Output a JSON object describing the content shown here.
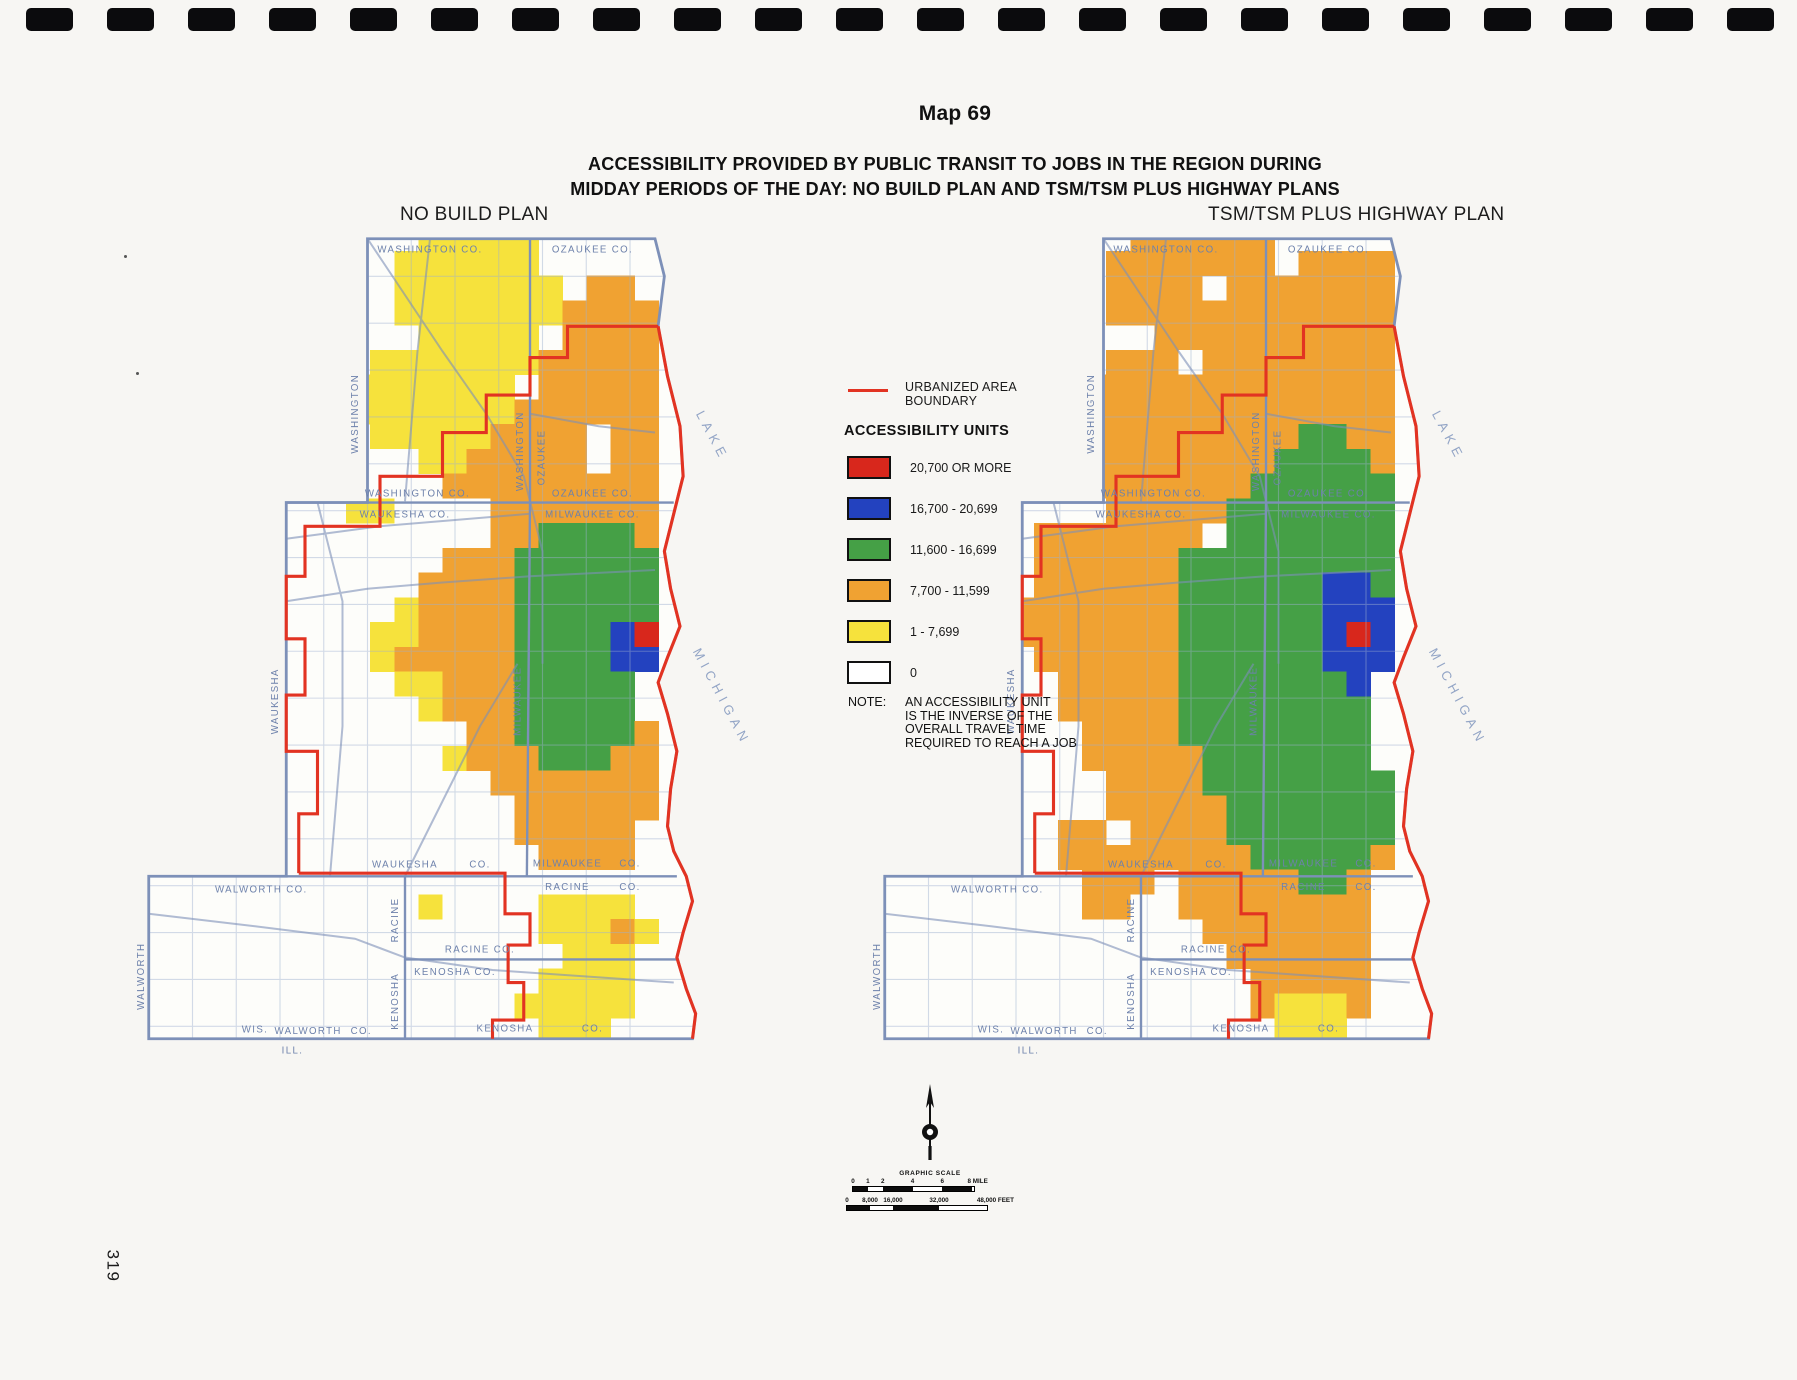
{
  "page": {
    "number": "319",
    "background": "#f7f6f3",
    "perforation_count": 23
  },
  "title": {
    "map_no": "Map 69",
    "line1": "ACCESSIBILITY PROVIDED BY PUBLIC TRANSIT TO JOBS IN THE REGION DURING",
    "line2": "MIDDAY PERIODS OF THE DAY:  NO BUILD PLAN AND TSM/TSM PLUS HIGHWAY PLANS"
  },
  "legend": {
    "boundary_label_line1": "URBANIZED AREA",
    "boundary_label_line2": "BOUNDARY",
    "boundary_color": "#e23322",
    "units_title": "ACCESSIBILITY UNITS",
    "items": [
      {
        "label": "20,700 OR MORE",
        "color": "#d8271c"
      },
      {
        "label": "16,700 - 20,699",
        "color": "#2342bf"
      },
      {
        "label": "11,600 - 16,699",
        "color": "#45a046"
      },
      {
        "label": "7,700 - 11,599",
        "color": "#f0a232"
      },
      {
        "label": "1 - 7,699",
        "color": "#f6e23c"
      },
      {
        "label": "0",
        "color": "#ffffff"
      }
    ],
    "note_label": "NOTE:",
    "note_lines": [
      "AN ACCESSIBILITY UNIT",
      "IS THE INVERSE OF THE",
      "OVERALL TRAVEL TIME",
      "REQUIRED TO REACH A JOB"
    ]
  },
  "scale": {
    "title": "GRAPHIC SCALE",
    "mile_ticks": [
      {
        "f": 0,
        "t": "0"
      },
      {
        "f": 0.125,
        "t": "1"
      },
      {
        "f": 0.25,
        "t": "2"
      },
      {
        "f": 0.5,
        "t": "4"
      },
      {
        "f": 0.75,
        "t": "6"
      },
      {
        "f": 1,
        "t": "8 MILE"
      }
    ],
    "feet_ticks": [
      {
        "f": 0,
        "t": "0"
      },
      {
        "f": 0.167,
        "t": "8,000"
      },
      {
        "f": 0.333,
        "t": "16,000"
      },
      {
        "f": 0.667,
        "t": "32,000"
      },
      {
        "f": 1,
        "t": "48,000 FEET"
      }
    ]
  },
  "palette": {
    "Y": "#f6e23c",
    "O": "#f0a232",
    "G": "#45a046",
    "B": "#2342bf",
    "R": "#d8271c"
  },
  "map_style": {
    "region_fill": "#fdfdfa",
    "line_color": "#7d90b8",
    "grid_color": "#9db0d0",
    "label_color": "#6d81ab",
    "lake_label_color": "#93a5c6",
    "urban_boundary_color": "#e23322"
  },
  "base_map": {
    "region": [
      [
        38,
        2
      ],
      [
        84,
        2
      ],
      [
        85.5,
        8
      ],
      [
        84.5,
        16
      ],
      [
        86,
        24
      ],
      [
        88,
        32
      ],
      [
        88.5,
        40
      ],
      [
        87,
        46
      ],
      [
        85.5,
        52
      ],
      [
        86.5,
        58
      ],
      [
        88,
        64
      ],
      [
        86,
        69
      ],
      [
        84.5,
        73
      ],
      [
        86,
        78
      ],
      [
        87.5,
        84
      ],
      [
        86.5,
        90
      ],
      [
        86,
        96
      ],
      [
        87,
        100
      ],
      [
        89,
        104
      ],
      [
        90,
        108
      ],
      [
        88.5,
        113
      ],
      [
        87.5,
        117
      ],
      [
        89,
        122
      ],
      [
        90.5,
        126
      ],
      [
        90,
        130
      ],
      [
        3,
        130
      ],
      [
        3,
        104
      ],
      [
        25,
        104
      ],
      [
        25,
        44.2
      ],
      [
        38,
        44.2
      ]
    ],
    "county_lines": [
      [
        [
          25,
          44.2
        ],
        [
          87,
          44.2
        ]
      ],
      [
        [
          3,
          104
        ],
        [
          87.5,
          104
        ]
      ],
      [
        [
          44,
          104
        ],
        [
          44,
          130
        ]
      ],
      [
        [
          44,
          117.3
        ],
        [
          87.7,
          117.3
        ]
      ],
      [
        [
          64,
          2
        ],
        [
          64,
          44.2
        ]
      ],
      [
        [
          64,
          44.2
        ],
        [
          63.5,
          104
        ]
      ]
    ],
    "shoreline_red": [
      [
        84.5,
        16
      ],
      [
        86,
        24
      ],
      [
        88,
        32
      ],
      [
        88.5,
        40
      ],
      [
        87,
        46
      ],
      [
        85.5,
        52
      ],
      [
        86.5,
        58
      ],
      [
        88,
        64
      ],
      [
        86,
        69
      ],
      [
        84.5,
        73
      ],
      [
        86,
        78
      ],
      [
        87.5,
        84
      ],
      [
        86.5,
        90
      ],
      [
        86,
        96
      ],
      [
        87,
        100
      ],
      [
        89,
        104
      ],
      [
        90,
        108
      ],
      [
        88.5,
        113
      ],
      [
        87.5,
        117
      ],
      [
        89,
        122
      ],
      [
        90.5,
        126
      ],
      [
        90,
        130
      ]
    ],
    "urban_boundary": [
      [
        [
          84.5,
          16
        ],
        [
          70,
          16
        ],
        [
          70,
          21
        ],
        [
          64,
          21
        ],
        [
          64,
          27
        ],
        [
          57,
          27
        ],
        [
          57,
          33
        ],
        [
          50,
          33
        ],
        [
          50,
          40
        ],
        [
          40,
          40
        ],
        [
          40,
          48
        ],
        [
          28,
          48
        ],
        [
          28,
          56
        ],
        [
          25,
          56
        ],
        [
          25,
          66
        ],
        [
          28,
          66
        ],
        [
          28,
          75
        ],
        [
          25,
          75
        ],
        [
          25,
          84
        ],
        [
          30,
          84
        ],
        [
          30,
          94
        ],
        [
          27,
          94
        ],
        [
          27,
          103.5
        ]
      ],
      [
        [
          27,
          103.5
        ],
        [
          60,
          103.5
        ],
        [
          60,
          110
        ],
        [
          64,
          110
        ],
        [
          64,
          115
        ],
        [
          60.5,
          115
        ],
        [
          60.5,
          121
        ],
        [
          63,
          121
        ],
        [
          63,
          127
        ],
        [
          58,
          127
        ],
        [
          58,
          130
        ]
      ]
    ],
    "highways": [
      [
        [
          38,
          2
        ],
        [
          50,
          20
        ],
        [
          57,
          30
        ],
        [
          63,
          40
        ],
        [
          66,
          52
        ],
        [
          66,
          70
        ]
      ],
      [
        [
          25,
          50
        ],
        [
          40,
          48
        ],
        [
          52,
          47
        ],
        [
          64,
          46
        ]
      ],
      [
        [
          25,
          60
        ],
        [
          38,
          58
        ],
        [
          50,
          57
        ],
        [
          64,
          56
        ],
        [
          84,
          55
        ]
      ],
      [
        [
          3,
          110
        ],
        [
          20,
          112
        ],
        [
          36,
          114
        ],
        [
          44,
          117
        ],
        [
          58,
          119
        ],
        [
          87,
          121
        ]
      ],
      [
        [
          30,
          44.2
        ],
        [
          34,
          60
        ],
        [
          34,
          80
        ],
        [
          32,
          104
        ]
      ],
      [
        [
          44,
          104
        ],
        [
          50,
          92
        ],
        [
          56,
          80
        ],
        [
          62,
          70
        ]
      ],
      [
        [
          48,
          2
        ],
        [
          46,
          20
        ],
        [
          44,
          44
        ]
      ],
      [
        [
          64,
          30
        ],
        [
          75,
          32
        ],
        [
          84,
          33
        ]
      ]
    ],
    "labels": [
      {
        "t": "WASHINGTON CO.",
        "x": 48,
        "y": 4.2
      },
      {
        "t": "OZAUKEE CO.",
        "x": 74,
        "y": 4.2
      },
      {
        "t": "WASHINGTON CO.",
        "x": 46,
        "y": 43.2
      },
      {
        "t": "WAUKESHA CO.",
        "x": 44,
        "y": 46.6
      },
      {
        "t": "OZAUKEE CO.",
        "x": 74,
        "y": 43.2
      },
      {
        "t": "MILWAUKEE CO.",
        "x": 74,
        "y": 46.6
      },
      {
        "t": "WAUKESHA",
        "x": 44,
        "y": 102.6
      },
      {
        "t": "CO.",
        "x": 56,
        "y": 102.6
      },
      {
        "t": "MILWAUKEE",
        "x": 70,
        "y": 102.4
      },
      {
        "t": "CO.",
        "x": 80,
        "y": 102.4
      },
      {
        "t": "RACINE",
        "x": 70,
        "y": 106.2
      },
      {
        "t": "CO.",
        "x": 80,
        "y": 106.2
      },
      {
        "t": "WALWORTH  CO.",
        "x": 21,
        "y": 106.6
      },
      {
        "t": "RACINE CO.",
        "x": 56,
        "y": 116.2
      },
      {
        "t": "KENOSHA  CO.",
        "x": 52,
        "y": 119.8
      },
      {
        "t": "KENOSHA",
        "x": 60,
        "y": 128.8
      },
      {
        "t": "CO.",
        "x": 74,
        "y": 128.8
      },
      {
        "t": "WIS.",
        "x": 20,
        "y": 129
      },
      {
        "t": "WALWORTH",
        "x": 28.5,
        "y": 129.2
      },
      {
        "t": "CO.",
        "x": 37,
        "y": 129.2
      },
      {
        "t": "ILL.",
        "x": 26,
        "y": 132.4
      },
      {
        "t": "WASHINGTON",
        "x": 36.5,
        "y": 30,
        "r": -90
      },
      {
        "t": "WASHINGTON",
        "x": 62.9,
        "y": 36,
        "r": -90
      },
      {
        "t": "OZAUKEE",
        "x": 66.3,
        "y": 37,
        "r": -90
      },
      {
        "t": "WAUKESHA",
        "x": 23.7,
        "y": 76,
        "r": -90
      },
      {
        "t": "MILWAUKEE",
        "x": 62.5,
        "y": 76,
        "r": -90
      },
      {
        "t": "WALWORTH",
        "x": 2.2,
        "y": 120,
        "r": -90
      },
      {
        "t": "RACINE",
        "x": 42.9,
        "y": 111,
        "r": -90
      },
      {
        "t": "KENOSHA",
        "x": 42.9,
        "y": 124,
        "r": -90
      },
      {
        "t": "LAKE",
        "x": 90.5,
        "y": 30,
        "r": 62,
        "lake": true
      },
      {
        "t": "MICHIGAN",
        "x": 90,
        "y": 68,
        "r": 62,
        "lake": true
      }
    ]
  },
  "maps": [
    {
      "id": "no-build",
      "label": "NO BUILD PLAN",
      "grid": [
        "............YYYYY.........",
        "...........YYYYYY.........",
        "...........YYYYYYY.OO.....",
        "...........YYYYYYYOOOO....",
        "............YYYYY.OOOO....",
        "..........YYYYYYYOOOOO....",
        "........YYYYYYYY.OOOOO....",
        "........YYYYYYYYOOOOOO....",
        "..........YYYYYOOOO.OO....",
        "............YYOOOOO.OO....",
        ".............OOOOOOOOO....",
        ".........YY....OOOOOOO....",
        "...............OOGGGGO....",
        ".............OOOGGGGGG....",
        "............OOOOGGGGGG....",
        "...........YOOOOGGGGGG....",
        "..........YYOOOOGGGGBR....",
        "..........YOOOOOGGGGBB....",
        "...........YYOOOGGGGG.....",
        "............YOOOGGGGG.....",
        "..............OOGGGGGO....",
        ".............YOOOGGGOO....",
        "...............OOOOOOO....",
        "................OOOOOO....",
        "................OOOOO.....",
        ".................OOOO.....",
        "..........................",
        "............Y....YYYY.....",
        ".................YYYOY....",
        "..................YYY.....",
        ".................YYYY.....",
        "................YYYYY.....",
        ".................YYY......",
        ".........................."
      ]
    },
    {
      "id": "tsm",
      "label": "TSM/TSM PLUS HIGHWAY PLAN",
      "grid": [
        "...........OOOOOO.........",
        "..........OOOOOOO.OOOO....",
        "..........OOOO.OOOOOOO....",
        "..........OOOOOOOOOOOO....",
        "............OOOOOOOOOO....",
        "..........OOO.OOOOOOOO....",
        "........OOOOOOOOOOOOOO....",
        "........OOOOOOOOOOOOOO....",
        "........OOOOOOOOOOGGOO....",
        "........OOOOOOOOOGGGGO....",
        ".......OOOOOOOOOGGGGGG....",
        "..........OOOOOGGGGGGG....",
        ".......OOOOOOO.GGGGGGG....",
        ".......OOOOOOGGGGGGGGG....",
        ".......OOOOOOGGGGGGBBG....",
        "......OOOOOOOGGGGGGBBB....",
        "......OOOOOOOGGGGGGBRB....",
        ".......OOOOOOGGGGGGBBB....",
        "........OOOOOGGGGGGGB.....",
        "........OOOOOGGGGGGGG.....",
        ".........OOOOGGGGGGGG.....",
        ".........OOOOOGGGGGGG.....",
        "..........OOOOGGGGGGGG....",
        "..........OOOOOGGGGGGG....",
        "........OO.OOOOGGGGGGG....",
        "........OOOOOOOOGGGGGO....",
        ".........OOO.OOOOOGGO.....",
        ".........OO..OOOOOOOO.....",
        "..............OOOOOOO.....",
        "...............OOOOOO.....",
        "................OOOOO.....",
        "................OYYYO.....",
        ".................YYY......",
        ".........................."
      ]
    }
  ]
}
